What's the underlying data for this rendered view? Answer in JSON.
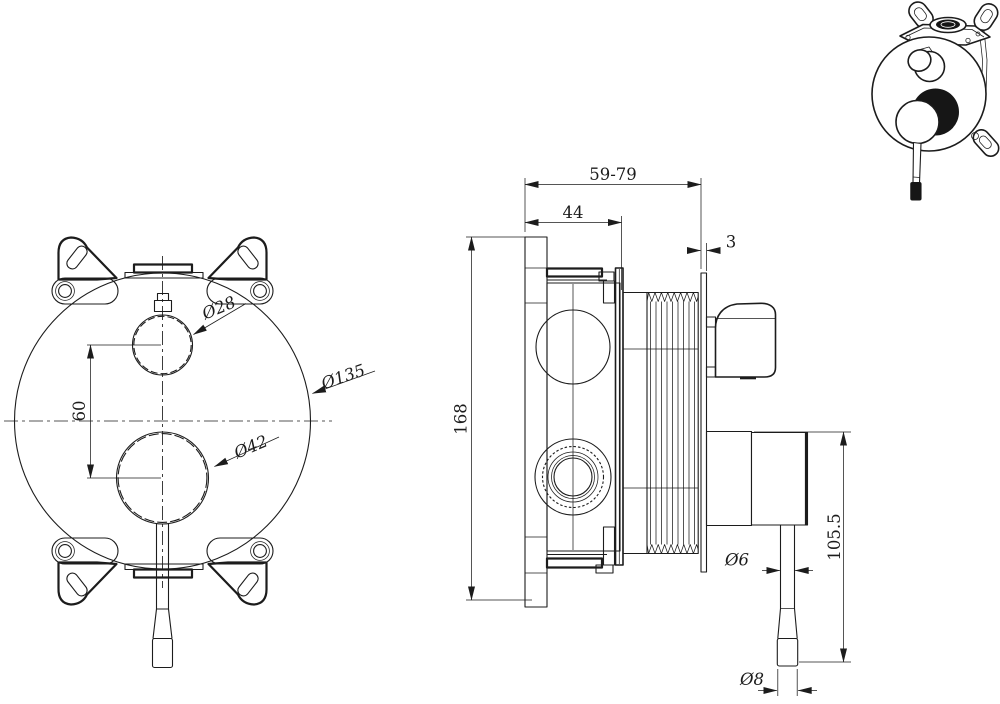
{
  "canvas": {
    "background": "#ffffff",
    "ink": "#1c1c1c",
    "accent_dark": "#161616"
  },
  "front_view": {
    "dim_knob_spacing": "60",
    "dim_top_knob_diameter": "Ø28",
    "dim_bottom_knob_diameter": "Ø42",
    "dim_plate_diameter": "Ø135"
  },
  "side_view": {
    "dim_depth_range": "59-79",
    "dim_body_depth": "44",
    "dim_wall_plate_thickness": "3",
    "dim_overall_height": "168",
    "dim_lever_rod_diameter": "Ø6",
    "dim_lever_height": "105.5",
    "dim_lever_tip_diameter": "Ø8"
  }
}
